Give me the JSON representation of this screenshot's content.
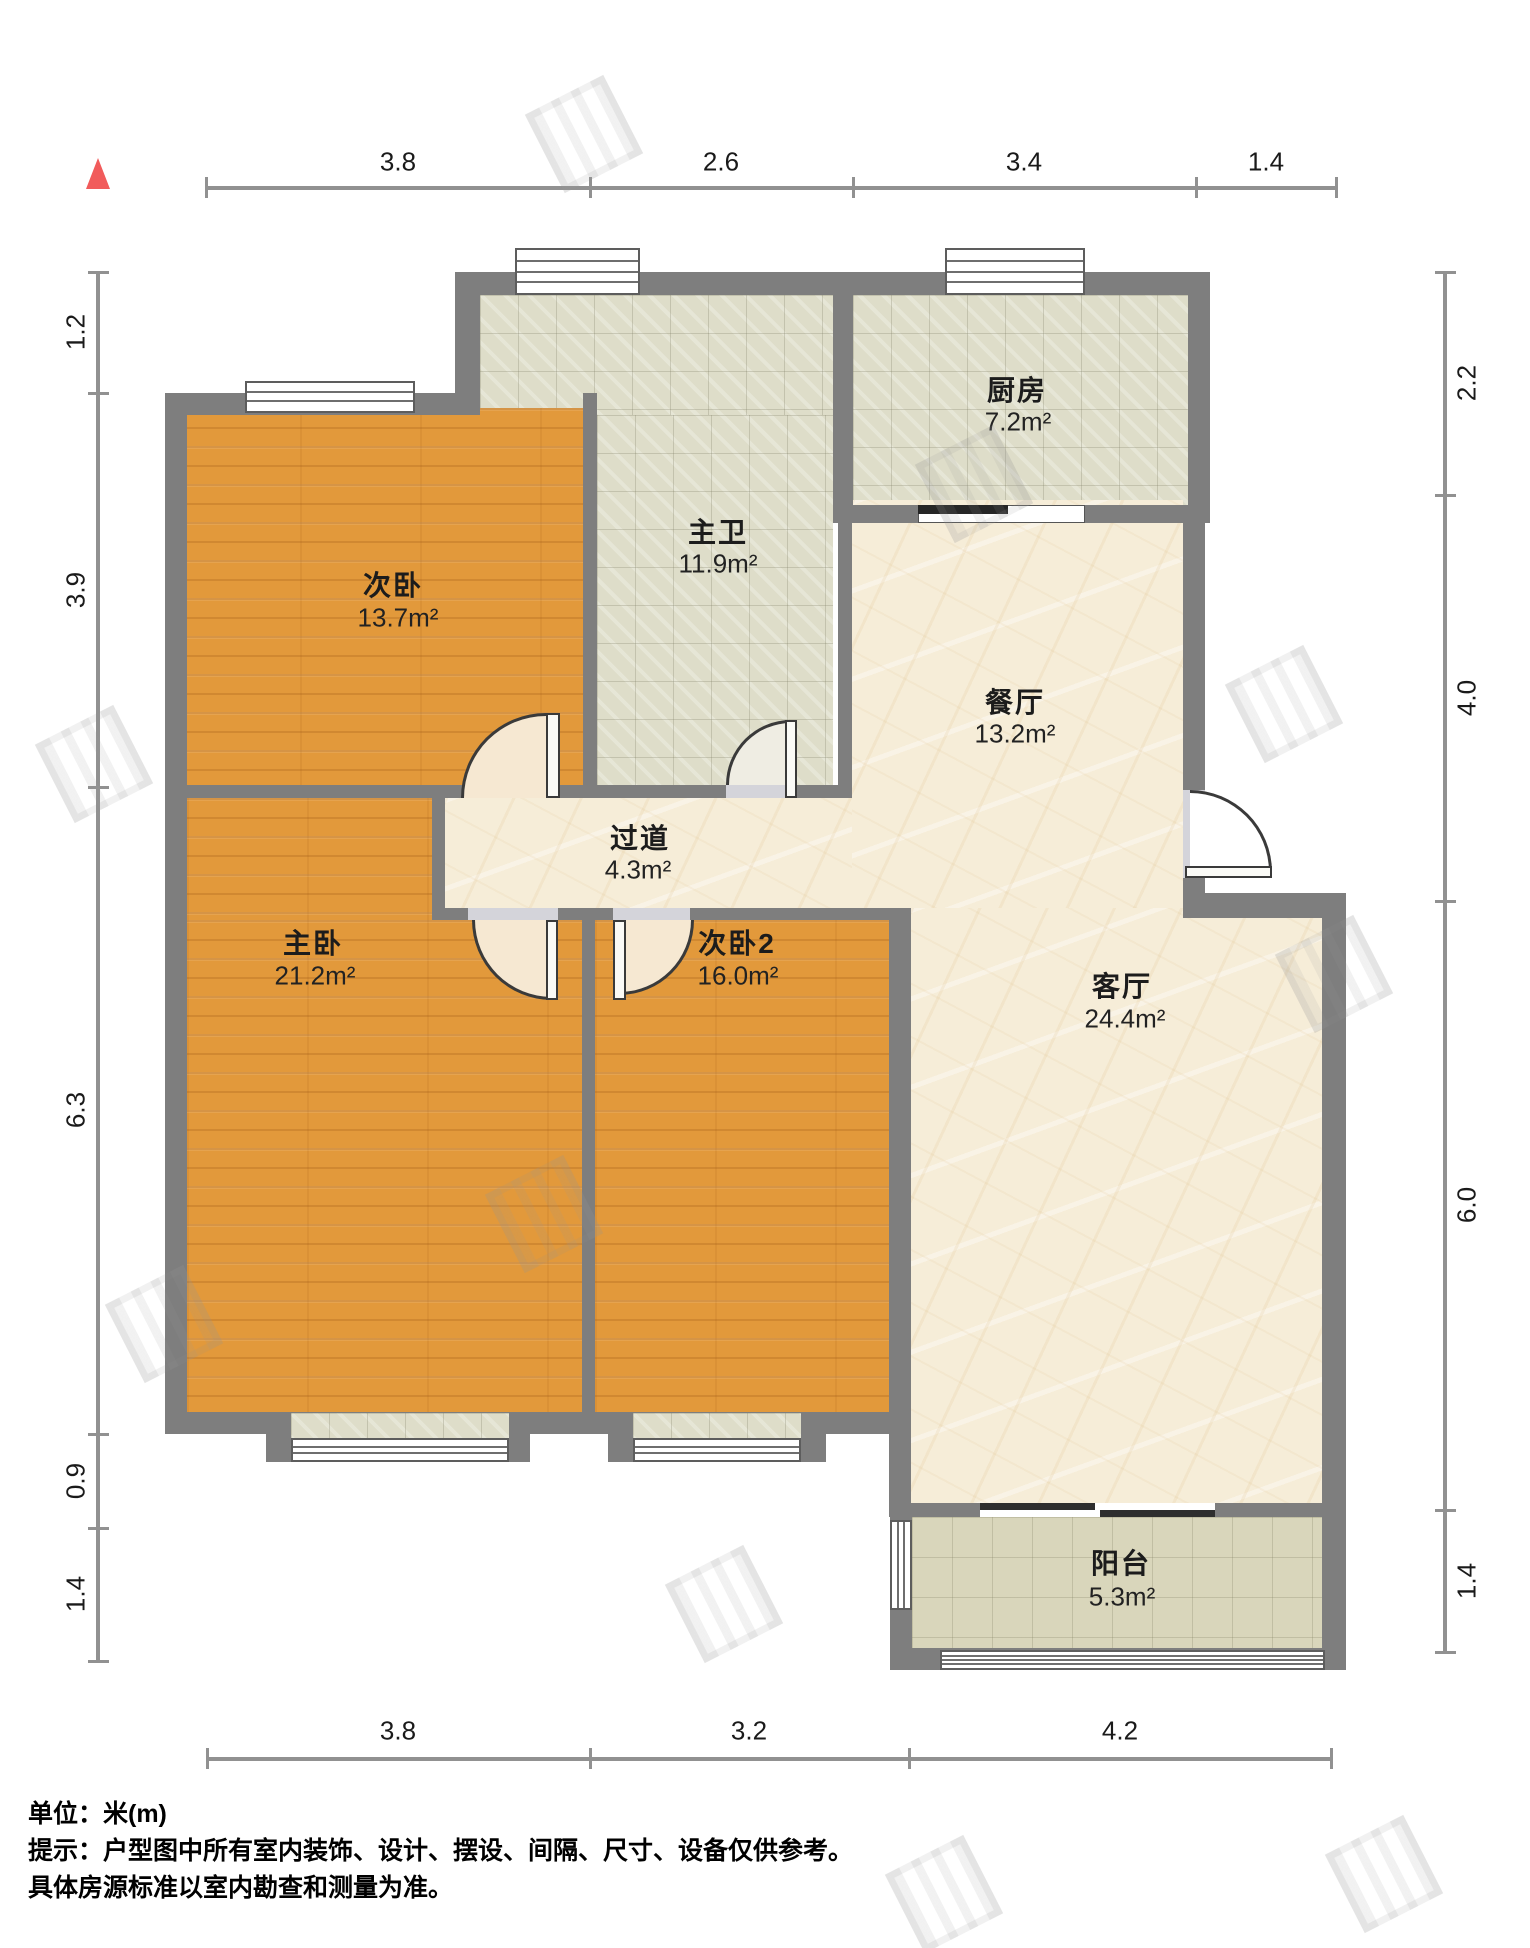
{
  "plan_title": "户型图",
  "unit_system": "米(m)",
  "north_indicator": "north-arrow",
  "rooms": [
    {
      "name": "次卧",
      "area": "13.7m²"
    },
    {
      "name": "主卫",
      "area": "11.9m²"
    },
    {
      "name": "厨房",
      "area": "7.2m²"
    },
    {
      "name": "餐厅",
      "area": "13.2m²"
    },
    {
      "name": "过道",
      "area": "4.3m²"
    },
    {
      "name": "主卧",
      "area": "21.2m²"
    },
    {
      "name": "次卧2",
      "area": "16.0m²"
    },
    {
      "name": "客厅",
      "area": "24.4m²"
    },
    {
      "name": "阳台",
      "area": "5.3m²"
    }
  ],
  "dimensions": {
    "top": [
      "3.8",
      "2.6",
      "3.4",
      "1.4"
    ],
    "bottom": [
      "3.8",
      "3.2",
      "4.2"
    ],
    "left": [
      "1.2",
      "3.9",
      "6.3",
      "0.9",
      "1.4"
    ],
    "right": [
      "2.2",
      "4.0",
      "6.0",
      "1.4"
    ]
  },
  "footer": {
    "unit": "单位：米(m)",
    "tip1": "提示：户型图中所有室内装饰、设计、摆设、间隔、尺寸、设备仅供参考。",
    "tip2": "具体房源标准以室内勘查和测量为准。"
  },
  "colors": {
    "wall": "#7E7E7E",
    "wood_floor": "#E2993B",
    "tile_floor": "#DEDDC9",
    "marble_floor": "#F6EDD8",
    "north_red": "#F15B5B"
  }
}
